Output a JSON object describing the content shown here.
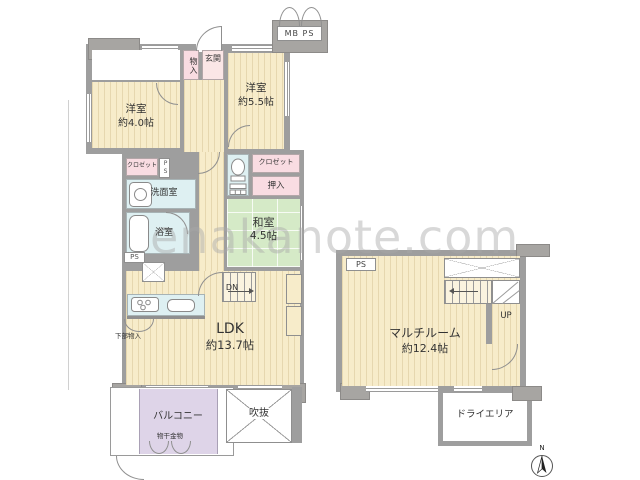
{
  "watermark": "enakanote.com",
  "colors": {
    "wall": "#9e9e9e",
    "wood_floor": "#f7ecca",
    "tatami": "#d5eac7",
    "closet_pink": "#f9dce2",
    "wet_area_cyan": "#def0f2",
    "balcony_lavender": "#ded4e8"
  },
  "unit_main": {
    "mb_ps": "MB PS",
    "entrance_storage": "物入",
    "entrance": "玄関",
    "bedroom_55": {
      "name": "洋室",
      "size": "約5.5帖"
    },
    "bedroom_40": {
      "name": "洋室",
      "size": "約4.0帖"
    },
    "closet_west": "クロゼット",
    "ps_shaft_1": "PS",
    "washroom": "洗面室",
    "bathroom": "浴室",
    "ps_shaft_2": "PS",
    "closet_east": "クロゼット",
    "futon_closet": "押入",
    "japanese_room": {
      "name": "和室",
      "size": "4.5帖"
    },
    "stairs_down": "DN",
    "living": {
      "name": "LDK",
      "size": "約13.7帖"
    },
    "under_counter_storage": "下部物入",
    "balcony": "バルコニー",
    "laundry_hardware": "物干金物",
    "open_void": "吹抜"
  },
  "unit_lower": {
    "ps_shaft": "PS",
    "multi_room": {
      "name": "マルチルーム",
      "size": "約12.4帖"
    },
    "stairs_up": "UP",
    "dry_area": "ドライエリア"
  },
  "compass": {
    "north": "N"
  }
}
